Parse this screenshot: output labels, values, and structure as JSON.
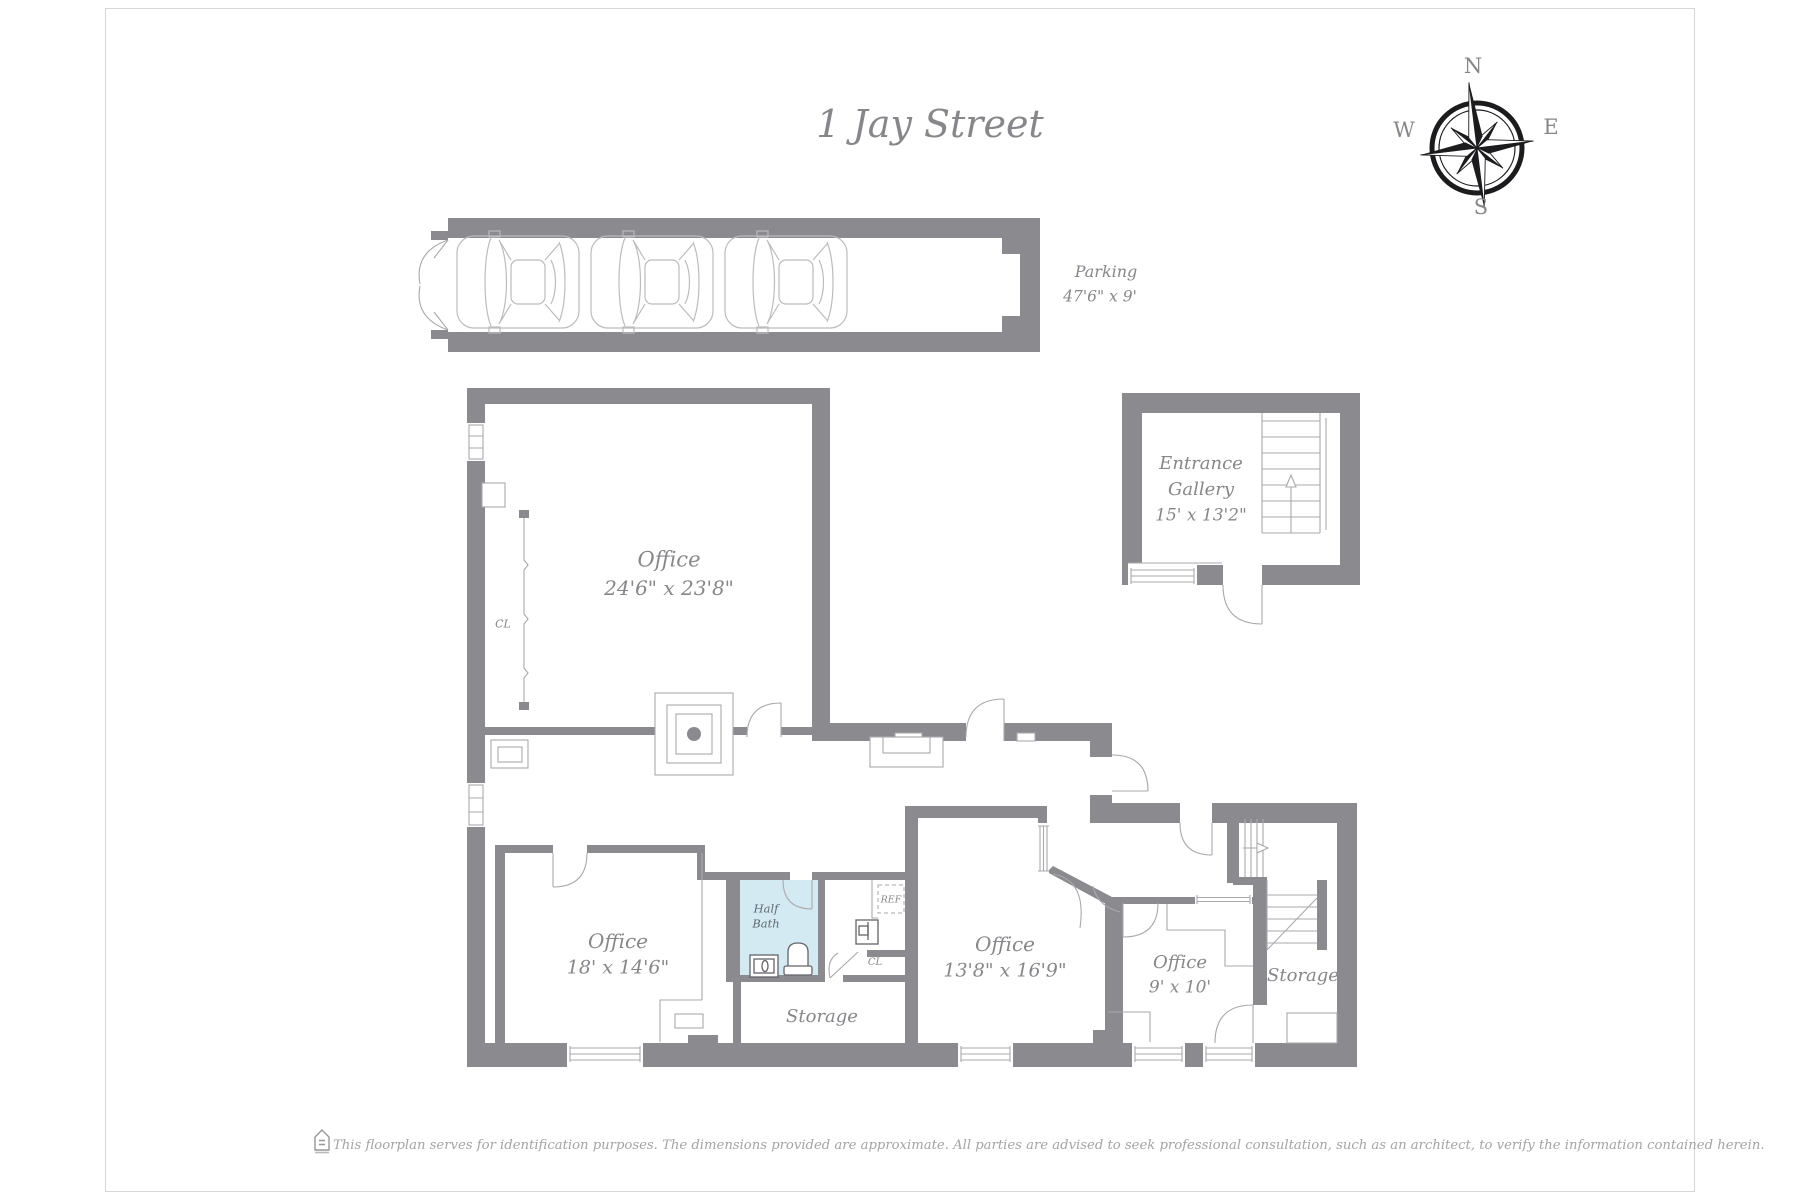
{
  "title": "1 Jay Street",
  "compass": {
    "n": "N",
    "e": "E",
    "s": "S",
    "w": "W"
  },
  "rooms": {
    "parking": {
      "name": "Parking",
      "dims": "47'6\" x 9'"
    },
    "office_large": {
      "name": "Office",
      "dims": "24'6\" x 23'8\""
    },
    "entrance_gallery": {
      "line1": "Entrance",
      "line2": "Gallery",
      "dims": "15' x 13'2\""
    },
    "office_left": {
      "name": "Office",
      "dims": "18' x 14'6\""
    },
    "half_bath": {
      "line1": "Half",
      "line2": "Bath"
    },
    "office_mid": {
      "name": "Office",
      "dims": "13'8\" x 16'9\""
    },
    "office_small": {
      "name": "Office",
      "dims": "9' x 10'"
    },
    "storage_mid": {
      "name": "Storage"
    },
    "storage_right": {
      "name": "Storage"
    },
    "closet_large_office": {
      "label": "CL"
    },
    "closet_hall": {
      "label": "CL"
    },
    "refrigerator": {
      "label": "REF"
    }
  },
  "footer": {
    "disclaimer": "This floorplan serves for identification purposes. The dimensions provided are approximate. All parties are advised to seek professional consultation, such as an architect, to verify the information contained herein."
  },
  "colors": {
    "wall": "#8b8b8f",
    "line": "#a9a9ad",
    "light_line": "#bcbcc0",
    "text": "#87878b",
    "text_dark": "#5f6a70",
    "bath_fill": "#d3eaf2",
    "compass_dark": "#1c1c1e",
    "footer_text": "#a4a4a8",
    "page_border": "#d6d6d8",
    "fixture": "#63636a"
  }
}
